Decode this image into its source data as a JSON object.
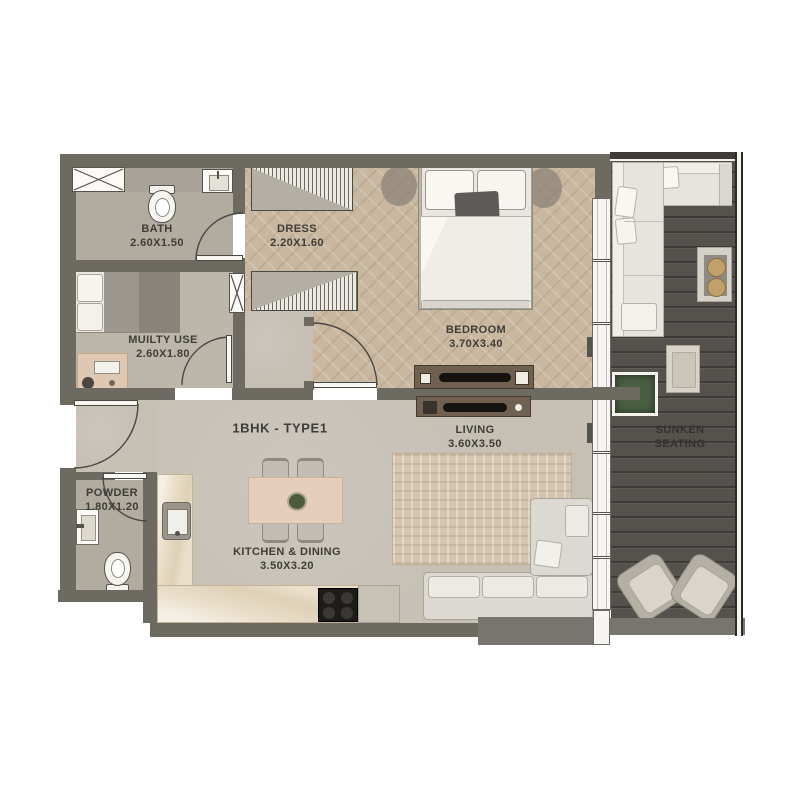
{
  "plan": {
    "title": "1BHK - TYPE1",
    "rooms": {
      "bath": {
        "name": "BATH",
        "dims": "2.60X1.50"
      },
      "dress": {
        "name": "DRESS",
        "dims": "2.20X1.60"
      },
      "bedroom": {
        "name": "BEDROOM",
        "dims": "3.70X3.40"
      },
      "multiuse": {
        "name": "MUILTY USE",
        "dims": "2.60X1.80"
      },
      "living": {
        "name": "LIVING",
        "dims": "3.60X3.50"
      },
      "powder": {
        "name": "POWDER",
        "dims": "1.80X1.20"
      },
      "kitchen": {
        "name": "KITCHEN & DINING",
        "dims": "3.50X3.20"
      },
      "sunken": {
        "name": "SUNKEN",
        "name2": "SEATING"
      }
    },
    "colors": {
      "wall": "#6c6a61",
      "floor_concrete": "#c5bfb4",
      "floor_wood": "#c9b7a0",
      "floor_bath": "#b2aba0",
      "deck": "#55524e",
      "counter": "#eadfca",
      "dining_table": "#e5cfbc",
      "text": "#3e3d39"
    }
  }
}
